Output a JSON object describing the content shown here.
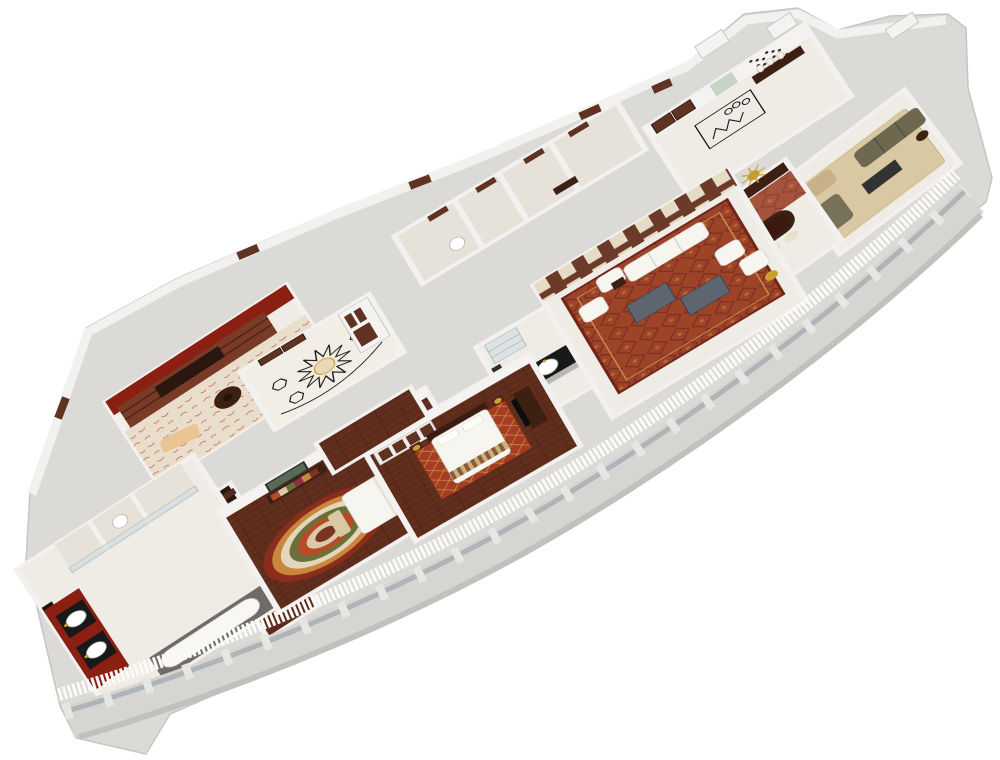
{
  "image_type": "3d-isometric-floor-plan-render",
  "background": "#ffffff",
  "palette": {
    "marble": "#efece5",
    "marble2": "#e6e2da",
    "base": "#dcdad7",
    "wall": "#f4f3f1",
    "wall_shade": "#c9c7c4",
    "wood_floor": "#5e2c1c",
    "wood_dark": "#3c2013",
    "wood_door": "#5f3222",
    "wood_panel": "#6b3a28",
    "red_wall": "#8a1f12",
    "carpet_red": "#9d4328",
    "carpet_red_dark": "#7a3020",
    "carpet_beige": "#e9decc",
    "rug_tan": "#d9c9a2",
    "soft_white": "#f7f5f0",
    "olive": "#6e6850",
    "gold": "#c9a22e",
    "sage": "#c7d4c5",
    "counter": "#191919",
    "glass": "#d7e0e2",
    "table_grey": "#5d6571",
    "cream": "#e9e0ca",
    "headboard_tan": "#8a6a42"
  },
  "rooms": [
    {
      "id": "master-bathroom",
      "name": "Master bathroom",
      "furniture": [
        "double vanity with twin round basins",
        "bathtub in window alcove",
        "shower stalls",
        "wc"
      ]
    },
    {
      "id": "walk-in-closet",
      "name": "Walk-in closet",
      "furniture": [
        "dark wood wardrobe shelving"
      ]
    },
    {
      "id": "study",
      "name": "Study / library",
      "furniture": [
        "wall bookshelves",
        "round reading table",
        "white armchair",
        "tan chaise"
      ]
    },
    {
      "id": "master-foyer",
      "name": "Master foyer",
      "furniture": [
        "star marble inlay floor",
        "double entry doors",
        "wardrobe"
      ]
    },
    {
      "id": "master-bedroom",
      "name": "Master bedroom",
      "furniture": [
        "king bed with tan headboard",
        "multicolor swirl rug",
        "dresser with artwork",
        "foot bench",
        "bedside tables with gold lamps"
      ]
    },
    {
      "id": "bedroom-2",
      "name": "Second bedroom",
      "furniture": [
        "double bed with striped runner",
        "red patterned rug",
        "tv console",
        "wardrobe",
        "bedside lamps"
      ]
    },
    {
      "id": "pantry-bar",
      "name": "Pantry / wet bar",
      "furniture": [
        "black bar counter with twin round sinks",
        "glass shelving unit"
      ]
    },
    {
      "id": "majlis",
      "name": "Majlis living room",
      "furniture": [
        "white sofa",
        "four white armchairs",
        "two grey coffee tables",
        "red patterned carpet",
        "wood panelled wall",
        "gold floor lamp"
      ]
    },
    {
      "id": "entry-foyer",
      "name": "Entry foyer",
      "furniture": [
        "console table with three vases",
        "dot wall art",
        "sage accent panel",
        "marble inlay floor",
        "entrance double door"
      ]
    },
    {
      "id": "dining-room",
      "name": "Dining room",
      "furniture": [
        "long dark dining table",
        "eight cream chairs",
        "sideboard",
        "gold sunburst mirror"
      ]
    },
    {
      "id": "sitting-room",
      "name": "Sitting room",
      "furniture": [
        "olive sofa",
        "tan armchair",
        "chaise",
        "dark coffee table",
        "tan rug"
      ]
    },
    {
      "id": "service-corridor",
      "name": "Service corridor",
      "furniture": [
        "wood doors",
        "small wc"
      ]
    }
  ],
  "facade": {
    "type": "curved window wall",
    "elements": [
      "grey parapet ledge",
      "glazing piers",
      "white sheer curtains"
    ]
  }
}
